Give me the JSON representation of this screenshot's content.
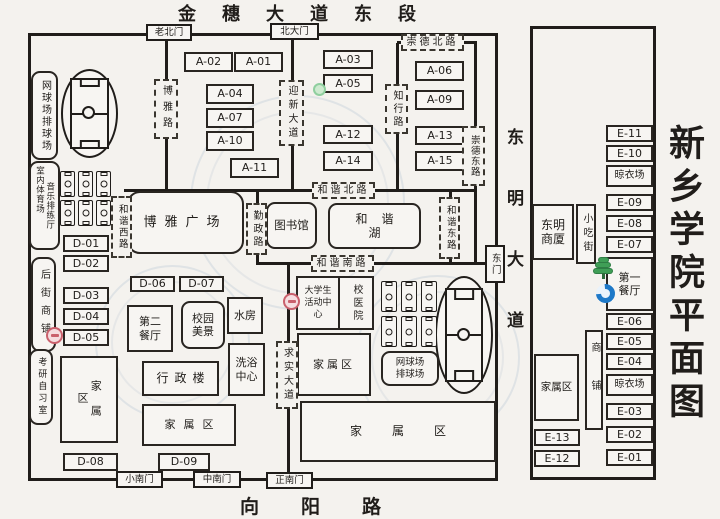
{
  "page": {
    "top_road": "金穗大道东段",
    "bottom_road": "向阳路",
    "east_avenue": "东明大道",
    "title_vertical": "新乡学院平面图"
  },
  "gates": {
    "old_north": "老北门",
    "north_main": "北大门",
    "east": "东门",
    "south_small": "小南门",
    "south_middle": "中南门",
    "south_main": "正南门"
  },
  "roads": {
    "boya": "博雅路",
    "yingxin": "迎新大道",
    "zhixing": "知行路",
    "chongde_north": "崇德北路",
    "chongde_east": "崇德东路",
    "hexie_west": "和谐西路",
    "hexie_north": "和谐北路",
    "hexie_east": "和谐东路",
    "hexie_south": "和谐南路",
    "qinzheng": "勤政路",
    "qiushi": "求实大道"
  },
  "buildings": {
    "a01": "A-01",
    "a02": "A-02",
    "a03": "A-03",
    "a04": "A-04",
    "a05": "A-05",
    "a06": "A-06",
    "a07": "A-07",
    "a09": "A-09",
    "a10": "A-10",
    "a11": "A-11",
    "a12": "A-12",
    "a13": "A-13",
    "a14": "A-14",
    "a15": "A-15",
    "d01": "D-01",
    "d02": "D-02",
    "d03": "D-03",
    "d04": "D-04",
    "d05": "D-05",
    "d06": "D-06",
    "d07": "D-07",
    "d08": "D-08",
    "d09": "D-09",
    "e01": "E-01",
    "e02": "E-02",
    "e03": "E-03",
    "e04": "E-04",
    "e05": "E-05",
    "e06": "E-06",
    "e07": "E-07",
    "e08": "E-08",
    "e09": "E-09",
    "e10": "E-10",
    "e11": "E-11",
    "e12": "E-12",
    "e13": "E-13"
  },
  "facilities": {
    "tennis_volleyball": "网球场排球场",
    "indoor_stadium": "室内体育场",
    "music_rehearsal": "音乐排练厅",
    "backstreet_shops": "后街商铺",
    "study_room": "考研自习室",
    "boya_square": "博雅广场",
    "library": "图书馆",
    "hexie_lake": "和谐湖",
    "second_canteen": "第二餐厅",
    "campus_scenery": "校园美景",
    "water_house": "水房",
    "bath_center": "洗浴中心",
    "admin_building": "行政楼",
    "family_area": "家属区",
    "student_center": "大学生活动中心",
    "school_hospital": "校医院",
    "first_canteen": "第一餐厅",
    "drying_area": "晾衣场",
    "dongming_mall": "东明商厦",
    "snack_street": "小吃街",
    "shops": "商铺"
  }
}
